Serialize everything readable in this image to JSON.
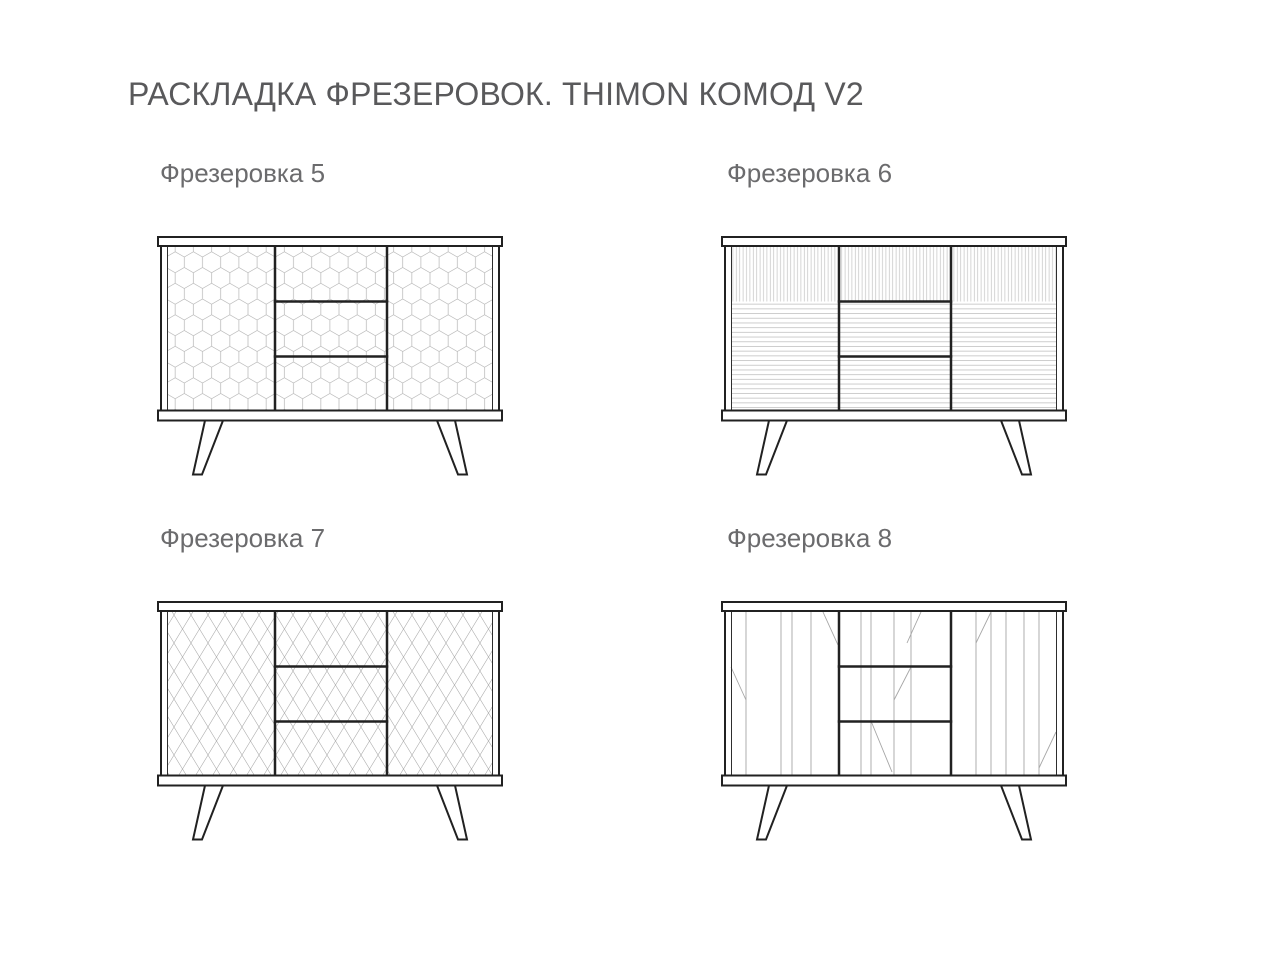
{
  "page": {
    "title": "РАСКЛАДКА ФРЕЗЕРОВОК. THIMON КОМОД V2"
  },
  "figures": [
    {
      "label": "Фрезеровка 5",
      "pattern": "hex",
      "pattern_desc": "honeycomb hexagon milling over doors and drawers"
    },
    {
      "label": "Фрезеровка 6",
      "pattern": "lines",
      "pattern_desc": "vertical ribs on upper band, horizontal ribs below"
    },
    {
      "label": "Фрезеровка 7",
      "pattern": "diamonds",
      "pattern_desc": "diamond lattice milling over doors and drawers"
    },
    {
      "label": "Фрезеровка 8",
      "pattern": "branches",
      "pattern_desc": "irregular vertical lines with diagonal branch accents"
    }
  ],
  "colors": {
    "background": "#ffffff",
    "outline": "#212121",
    "pattern_line": "#b2b2b2",
    "title_text": "#59595b",
    "label_text": "#6b6b6d"
  }
}
